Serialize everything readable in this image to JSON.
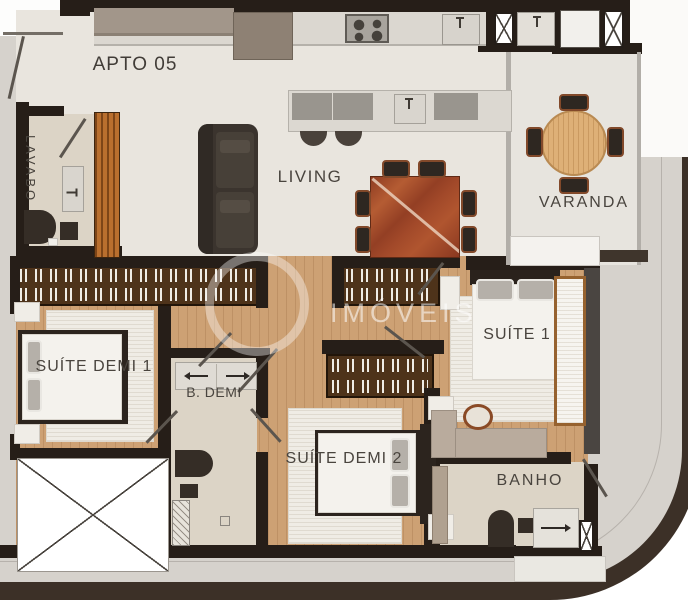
{
  "unit": {
    "label": "APTO 05"
  },
  "rooms": {
    "lavabo": "LAVABO",
    "living": "LIVING",
    "varanda": "VARANDA",
    "suite_demi_1": "SUÍTE DEMI 1",
    "b_demi": "B. DEMI",
    "suite_1": "SUÍTE 1",
    "suite_demi_2": "SUÍTE DEMI 2",
    "banho": "BANHO"
  },
  "watermark": {
    "text": "IMÓVEIS"
  },
  "palette": {
    "wall": "#261e18",
    "floor_living": "#e9e5de",
    "floor_wood": "#cda174",
    "floor_bath": "#dcd4c6",
    "slab_band": "#d6d2cc",
    "edge_dark": "#3c3027",
    "wood_slat_panel": "#b96f2e",
    "marble_table": "#a34a2a",
    "varanda_table": "#deb077",
    "wardrobe": "#4e331a",
    "label_text": "#49443e"
  }
}
